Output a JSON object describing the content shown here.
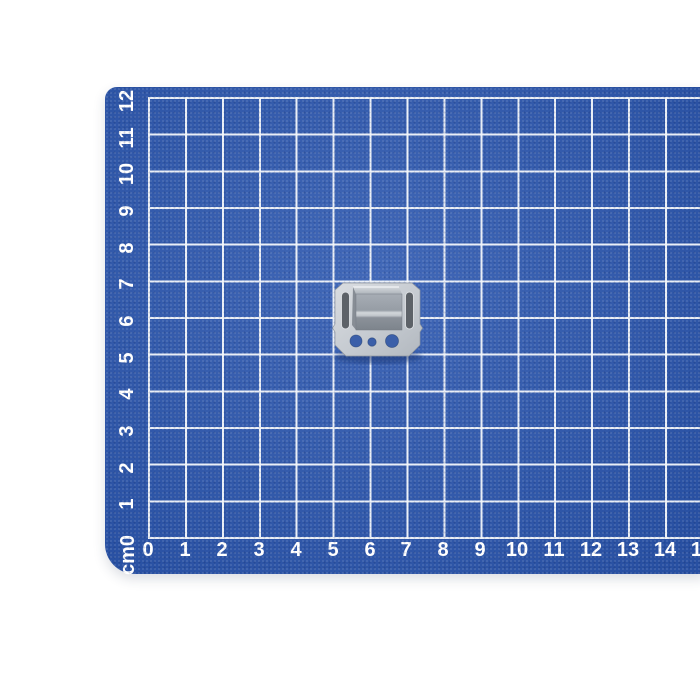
{
  "photo": {
    "background_color": "#ffffff"
  },
  "mat": {
    "surface_color": "#2d58b0",
    "grid_line_color": "#f3f6fa",
    "label_color": "#ffffff",
    "corner_unit_label": "cm0",
    "x_axis_labels": [
      "0",
      "1",
      "2",
      "3",
      "4",
      "5",
      "6",
      "7",
      "8",
      "9",
      "10",
      "11",
      "12",
      "13",
      "14",
      "15"
    ],
    "y_axis_labels": [
      "1",
      "2",
      "3",
      "4",
      "5",
      "6",
      "7",
      "8",
      "9",
      "10",
      "11",
      "12"
    ]
  },
  "clip": {
    "name": "metal mounting clip",
    "plate_color": "#c9cdd2",
    "slot_color": "#5d6268",
    "hole_color": "#3b5fa9",
    "raised_box_top_color": "#b9bec4",
    "raised_box_front_color": "#9ca3ab",
    "shadow_color": "#14306e"
  }
}
